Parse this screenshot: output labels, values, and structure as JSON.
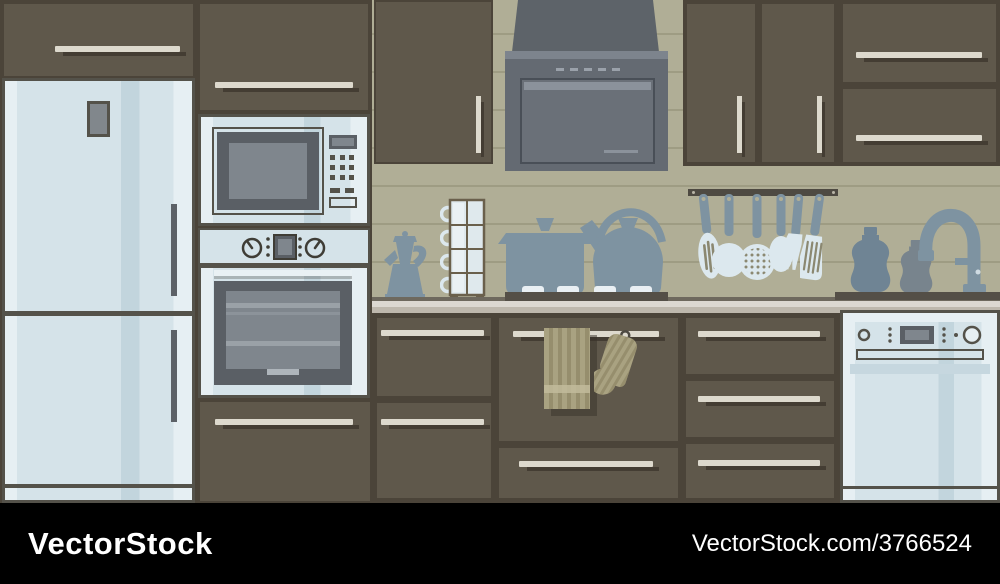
{
  "meta": {
    "type": "stock vector illustration",
    "subject": "Modern kitchen interior with built-in appliances, flat style"
  },
  "watermark": {
    "brand": "VectorStock",
    "site_ref": "VectorStock.com/3766524"
  },
  "palette": {
    "cabinet": "#5f584b",
    "cabinet_dark": "#4b4439",
    "wall": "#b0ae96",
    "wall_line": "#9e9c83",
    "appliance": "#d5e3e9",
    "appliance_shade": "#c2d5dd",
    "appliance_highlight": "#e6eff3",
    "outline": "#54524a",
    "steel": "#646a72",
    "steel_light": "#7d848d",
    "steel_panel": "#6a7078",
    "steel_panel_light": "#8b929b",
    "silhouette": "#7e93a1",
    "utensil_light": "#dce8ee",
    "hole": "#8b8871",
    "counter": "#dcd8d1",
    "counter_shade": "#beb8ad",
    "counter_edge": "#6e695e",
    "cooktop": "#544f47",
    "textile": "#a9a281",
    "textile_dark": "#968e6d",
    "textile_light": "#c2bb9b",
    "handle": "#ddd9cd",
    "fridge_handle": "#5c6167",
    "rack": "#4e4a42",
    "window_dark": "#5a5f65",
    "window_screen": "#7f868d",
    "oven_rack": "#9aa1a7",
    "frame_wood": "#6a604c",
    "bar": "#000000",
    "text": "#ffffff"
  },
  "appliances": [
    "refrigerator",
    "microwave",
    "wall-oven",
    "range-hood",
    "cooktop",
    "dishwasher"
  ],
  "countertop_items": [
    "moka-pot",
    "cup-stand",
    "stockpot",
    "kettle",
    "soap-bottle-large",
    "soap-bottle-small",
    "faucet"
  ],
  "utensil_rack": [
    "slotted-spoon",
    "ladle",
    "skimmer",
    "spoon",
    "carving-fork",
    "turner"
  ],
  "textiles": [
    "dish-towel",
    "oven-mitt"
  ],
  "counts": {
    "upper_doors": 7,
    "lower_drawers": 7,
    "burners": 4,
    "utensils": 6
  }
}
